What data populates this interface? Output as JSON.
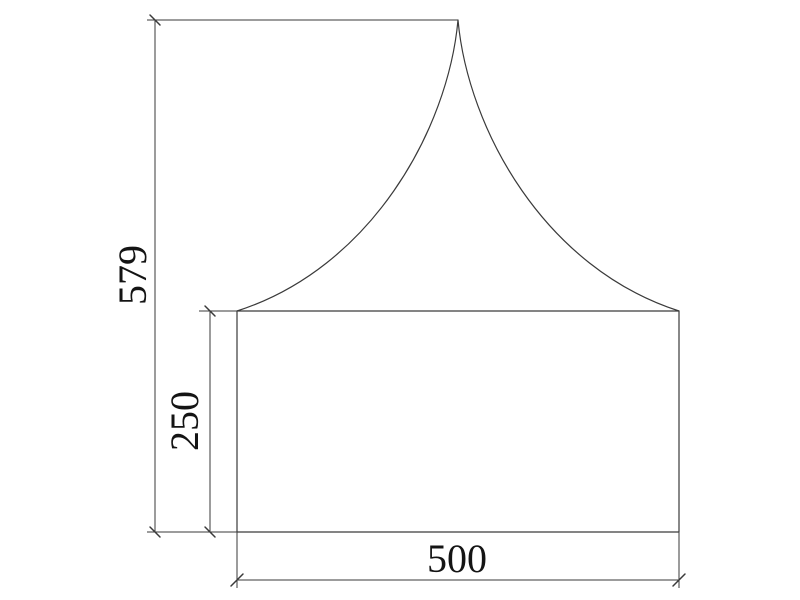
{
  "drawing": {
    "type": "cad-dimensioned-elevation",
    "background": "#ffffff",
    "stroke_color": "#3a3a3a",
    "text_color": "#141414",
    "dimensions": {
      "overall_height": {
        "value": "579",
        "orientation": "vertical"
      },
      "wall_height": {
        "value": "250",
        "orientation": "vertical"
      },
      "base_width": {
        "value": "500",
        "orientation": "horizontal"
      }
    }
  }
}
